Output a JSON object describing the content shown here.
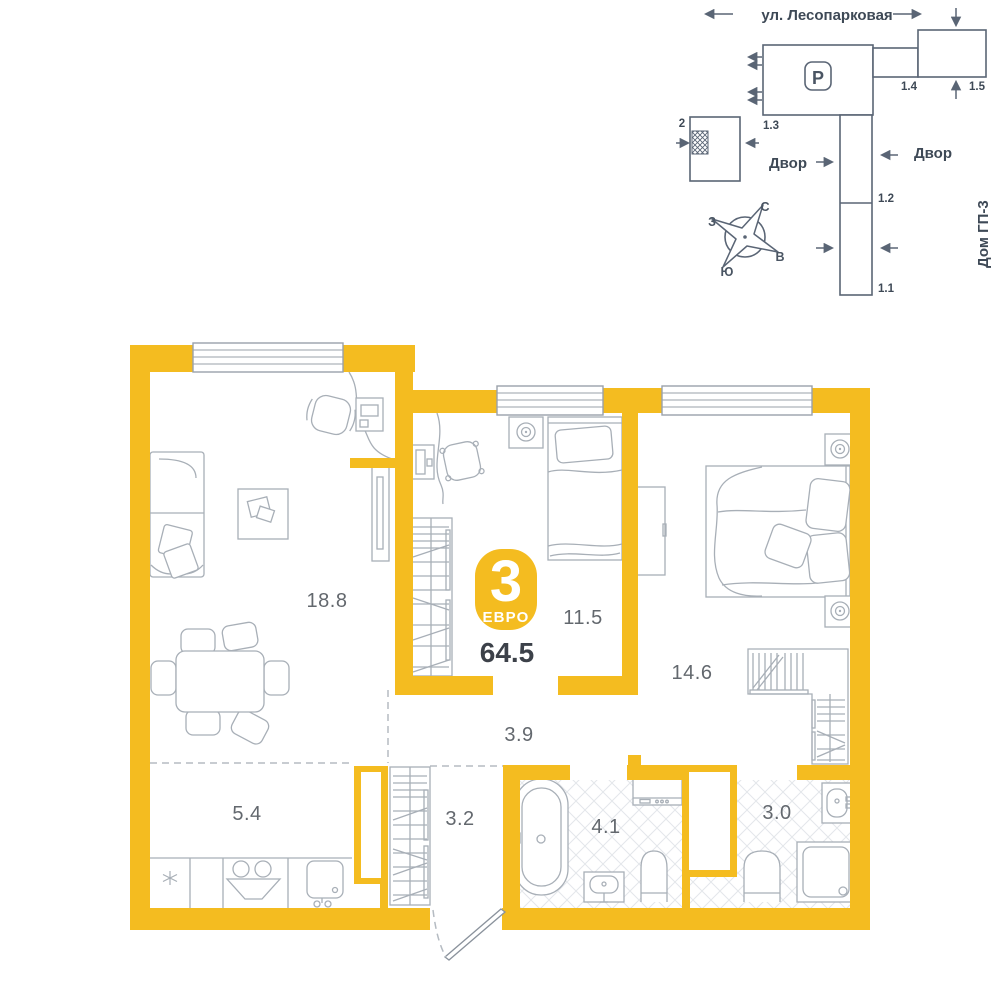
{
  "site_plan": {
    "street": "ул. Лесопарковая",
    "yard_left": "Двор",
    "yard_right": "Двор",
    "neighbor_house": "Дом ГП-3",
    "parking": "P",
    "building_current": "2",
    "b_13": "1.3",
    "b_14": "1.4",
    "b_15": "1.5",
    "b_12": "1.2",
    "b_11": "1.1",
    "compass": {
      "n": "С",
      "e": "В",
      "s": "Ю",
      "w": "З"
    }
  },
  "apartment": {
    "badge_rooms": "3",
    "badge_type": "ЕВРО",
    "total_area": "64.5",
    "areas": {
      "living": "18.8",
      "bedroom2": "11.5",
      "bedroom1": "14.6",
      "hall": "3.9",
      "kitchen": "5.4",
      "entry": "3.2",
      "bathroom": "4.1",
      "ensuite": "3.0"
    }
  },
  "colors": {
    "wall": "#F4BC20",
    "furniture_line": "#A8AFB7",
    "site_line": "#5A6575",
    "label_text": "#63686E",
    "dark_text": "#3C4149"
  }
}
